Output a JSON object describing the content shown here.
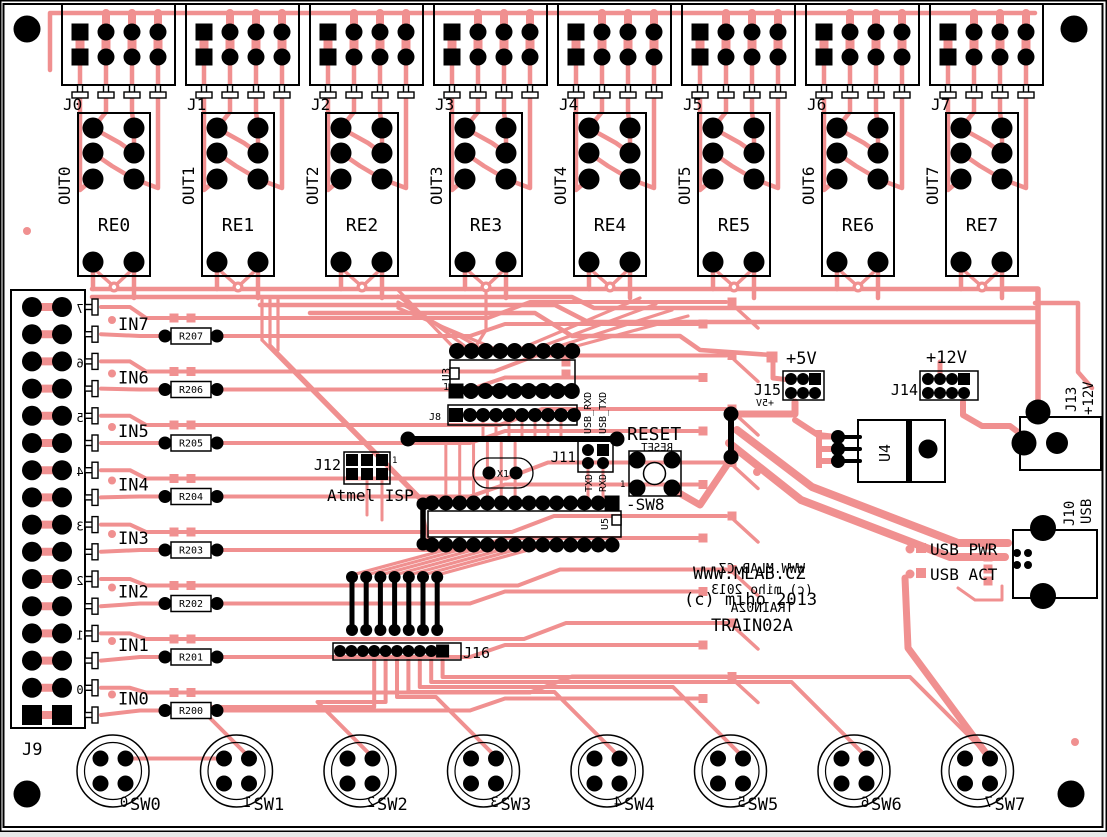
{
  "title": "TRAIN02A PCB layout",
  "colors": {
    "copper": "#f09090",
    "silkscreen": "#000000",
    "board": "#ffffff"
  },
  "branding": {
    "website": "WWW.MLAB.CZ",
    "copyright": "(c) miho 2013",
    "board_name": "TRAIN02A",
    "website_mirror": "WWW.MLAB.CZ",
    "copyright_mirror": "(c) miho 2013",
    "board_name_mirror": "TRAIN02A"
  },
  "relay_channels": [
    {
      "connector": "J0",
      "relay": "RE0",
      "output": "OUT0"
    },
    {
      "connector": "J1",
      "relay": "RE1",
      "output": "OUT1"
    },
    {
      "connector": "J2",
      "relay": "RE2",
      "output": "OUT2"
    },
    {
      "connector": "J3",
      "relay": "RE3",
      "output": "OUT3"
    },
    {
      "connector": "J4",
      "relay": "RE4",
      "output": "OUT4"
    },
    {
      "connector": "J5",
      "relay": "RE5",
      "output": "OUT5"
    },
    {
      "connector": "J6",
      "relay": "RE6",
      "output": "OUT6"
    },
    {
      "connector": "J7",
      "relay": "RE7",
      "output": "OUT7"
    }
  ],
  "input_section": {
    "connector": "J9",
    "inputs": [
      {
        "label": "IN7",
        "resistor": "R207",
        "pin_digit": "7"
      },
      {
        "label": "IN6",
        "resistor": "R206",
        "pin_digit": "6"
      },
      {
        "label": "IN5",
        "resistor": "R205",
        "pin_digit": "5"
      },
      {
        "label": "IN4",
        "resistor": "R204",
        "pin_digit": "4"
      },
      {
        "label": "IN3",
        "resistor": "R203",
        "pin_digit": "3"
      },
      {
        "label": "IN2",
        "resistor": "R202",
        "pin_digit": "2"
      },
      {
        "label": "IN1",
        "resistor": "R201",
        "pin_digit": "1"
      },
      {
        "label": "IN0",
        "resistor": "R200",
        "pin_digit": "0"
      }
    ]
  },
  "switches": [
    {
      "label": "SW0",
      "pin_digit": "0"
    },
    {
      "label": "SW1",
      "pin_digit": "1"
    },
    {
      "label": "SW2",
      "pin_digit": "2"
    },
    {
      "label": "SW3",
      "pin_digit": "3"
    },
    {
      "label": "SW4",
      "pin_digit": "4"
    },
    {
      "label": "SW5",
      "pin_digit": "5"
    },
    {
      "label": "SW6",
      "pin_digit": "6"
    },
    {
      "label": "SW7",
      "pin_digit": "7"
    }
  ],
  "mcu_section": {
    "u3": "U3",
    "u3_pin1": "1",
    "j8": "J8",
    "usb_rxd": "USB_RXD",
    "usb_txd": "USB_TXD",
    "j11": "J11",
    "txd": "TXD",
    "rxd": "RXD",
    "x1": "X1",
    "reset": "RESET",
    "reset_mirror": "RESET",
    "sw8": "-SW8",
    "sw8_pin1": "1",
    "u5": "U5",
    "j12": "J12",
    "j12_pin1": "1",
    "atmel_isp": "Atmel ISP",
    "j16": "J16"
  },
  "power_section": {
    "plus5v": "+5V",
    "plus5v_mirror": "+5V",
    "j15": "J15",
    "plus12v": "+12V",
    "j14": "J14",
    "u4": "U4",
    "j13": "J13",
    "j13_voltage": "+12V",
    "j10": "J10",
    "j10_type": "USB",
    "usb_pwr": "USB PWR",
    "usb_act": "USB ACT"
  }
}
